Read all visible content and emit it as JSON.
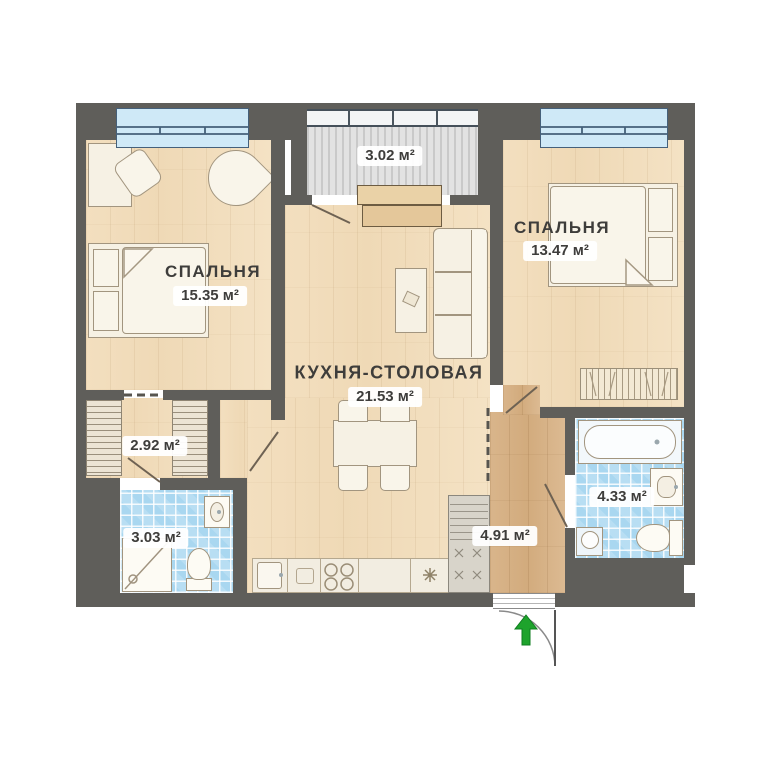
{
  "plan": {
    "type": "apartment-floor-plan",
    "language": "ru",
    "rooms": {
      "bedroom1": {
        "name": "СПАЛЬНЯ",
        "area": "15.35 м²"
      },
      "bedroom2": {
        "name": "СПАЛЬНЯ",
        "area": "13.47 м²"
      },
      "kitchen": {
        "name": "КУХНЯ-СТОЛОВАЯ",
        "area": "21.53 м²"
      },
      "balcony": {
        "area": "3.02 м²"
      },
      "wardrobe_hall": {
        "area": "2.92 м²"
      },
      "bathroom_small": {
        "area": "3.03 м²"
      },
      "bathroom_large": {
        "area": "4.33 м²"
      },
      "entrance_hall": {
        "area": "4.91 м²"
      }
    },
    "colors": {
      "wall": "#5f5e5a",
      "wood_floor": "#f2debd",
      "hall_floor": "#d6b187",
      "tile": "#a9d7f0",
      "window": "#cfe9f7",
      "balcony_floor": "#dedede",
      "entrance_arrow": "#1ea32c",
      "label_text": "#3e3d3b"
    },
    "icons": {
      "entrance": "arrow-up-icon"
    }
  }
}
